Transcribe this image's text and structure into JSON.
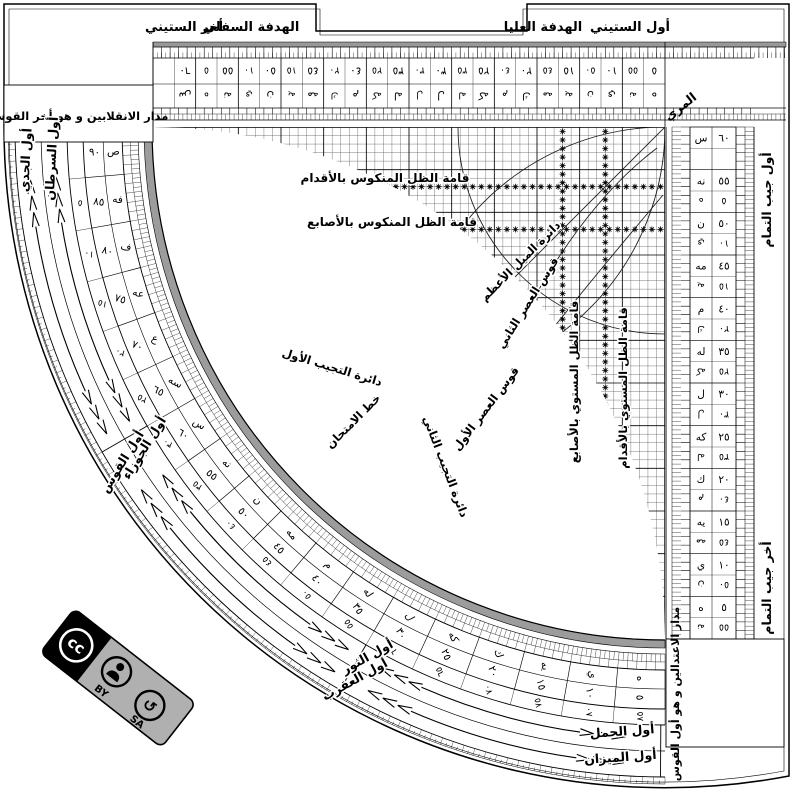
{
  "top_band": {
    "awwal_sittini": "أول الستيني",
    "hadafa_ulya": "الهدفة العليا",
    "hadafa_sufla": "الهدفة السفلي",
    "akhir_sittini": "أخر الستيني"
  },
  "corner_boxes": {
    "inqilabayn": "مدار الانقلابين و هو أخر القوس",
    "itidalayn": "مدار الاعتدالين و هو أول القوس"
  },
  "side_labels": {
    "muri": "المري",
    "awwal_jayb_tamam": "أول جيب التمام",
    "akhir_jayb_tamam": "أخر جيب التمام"
  },
  "grid_labels": {
    "mankus_aqdam": "قامة الظل المنكوس بالأقدام",
    "mankus_asabi": "قامة الظل المنكوس بالأصابع",
    "mustawi_asabi": "قامة الظل المستوي بالأصابع",
    "mustawi_aqdam": "قامة الظل المستوي بالأقدام",
    "mayl_azam": "دائرة الميل الأعظم",
    "asr_awwal": "قوس العصر الأول",
    "asr_thani": "قوس العصر الثاني",
    "tajyib_awwal": "دائرة التجيب الأول",
    "tajyib_thani": "دائرة التجيب الثاني",
    "imtihan": "خط الامتحان"
  },
  "zodiac": {
    "outer": [
      {
        "label": "أول الميزان",
        "deg": 4
      },
      {
        "label": "أول العقرب",
        "deg": 29
      },
      {
        "label": "أول القوس",
        "deg": 58
      },
      {
        "label": "أول الجدي",
        "deg": 87
      }
    ],
    "inner": [
      {
        "label": "أول الحمل",
        "deg": 4
      },
      {
        "label": "أول الثور",
        "deg": 29
      },
      {
        "label": "أول الجوزاء",
        "deg": 58
      },
      {
        "label": "أول السرطان",
        "deg": 87
      }
    ]
  },
  "scales": {
    "abjad": [
      "ص",
      "فه",
      "ف",
      "عه",
      "ع",
      "سه",
      "س",
      "نه",
      "ن",
      "مه",
      "م",
      "له",
      "ل",
      "كه",
      "ك",
      "يه",
      "ي",
      "ه"
    ],
    "numbers": [
      "٩٠",
      "٨٥",
      "٨٠",
      "٧٥",
      "٧٠",
      "٦٥",
      "٦٠",
      "٥٥",
      "٥٠",
      "٤٥",
      "٤٠",
      "٣٥",
      "٣٠",
      "٢٥",
      "٢٠",
      "١٥",
      "١٠",
      "٥"
    ],
    "complement_numbers": [
      "",
      "٥",
      "١٠",
      "١٥",
      "٢٠",
      "٢٥",
      "٣٠",
      "٣٥",
      "٤٠",
      "٤٥",
      "٥٠",
      "٥٥",
      "٦٠",
      "٦٥",
      "٧٠",
      "٧٥",
      "٨٠",
      "٨٥"
    ],
    "sixty_numbers": [
      "٦٠",
      "٥٥",
      "٥٠",
      "٤٥",
      "٤٠",
      "٣٥",
      "٣٠",
      "٢٥",
      "٢٠",
      "١٥",
      "١٠",
      "٥"
    ],
    "sixty_abjad": [
      "س",
      "نه",
      "ن",
      "مه",
      "م",
      "له",
      "ل",
      "كه",
      "ك",
      "يه",
      "ي",
      "ه"
    ],
    "sixty_comp_numbers": [
      "",
      "٥",
      "١٠",
      "١٥",
      "٢٠",
      "٢٥",
      "٣٠",
      "٣٥",
      "٤٠",
      "٤٥",
      "٥٠",
      "٥٥"
    ],
    "sixty_comp_abjad": [
      "",
      "ه",
      "ي",
      "يه",
      "ك",
      "كه",
      "ل",
      "له",
      "م",
      "مه",
      "ن",
      "نه"
    ]
  },
  "cc_badge": {
    "cc": "cc",
    "by": "BY",
    "sa": "SA"
  },
  "colors": {
    "ink": "#000000",
    "gray_band": "#9c9c9c",
    "badge_gray": "#b0b0b0"
  }
}
